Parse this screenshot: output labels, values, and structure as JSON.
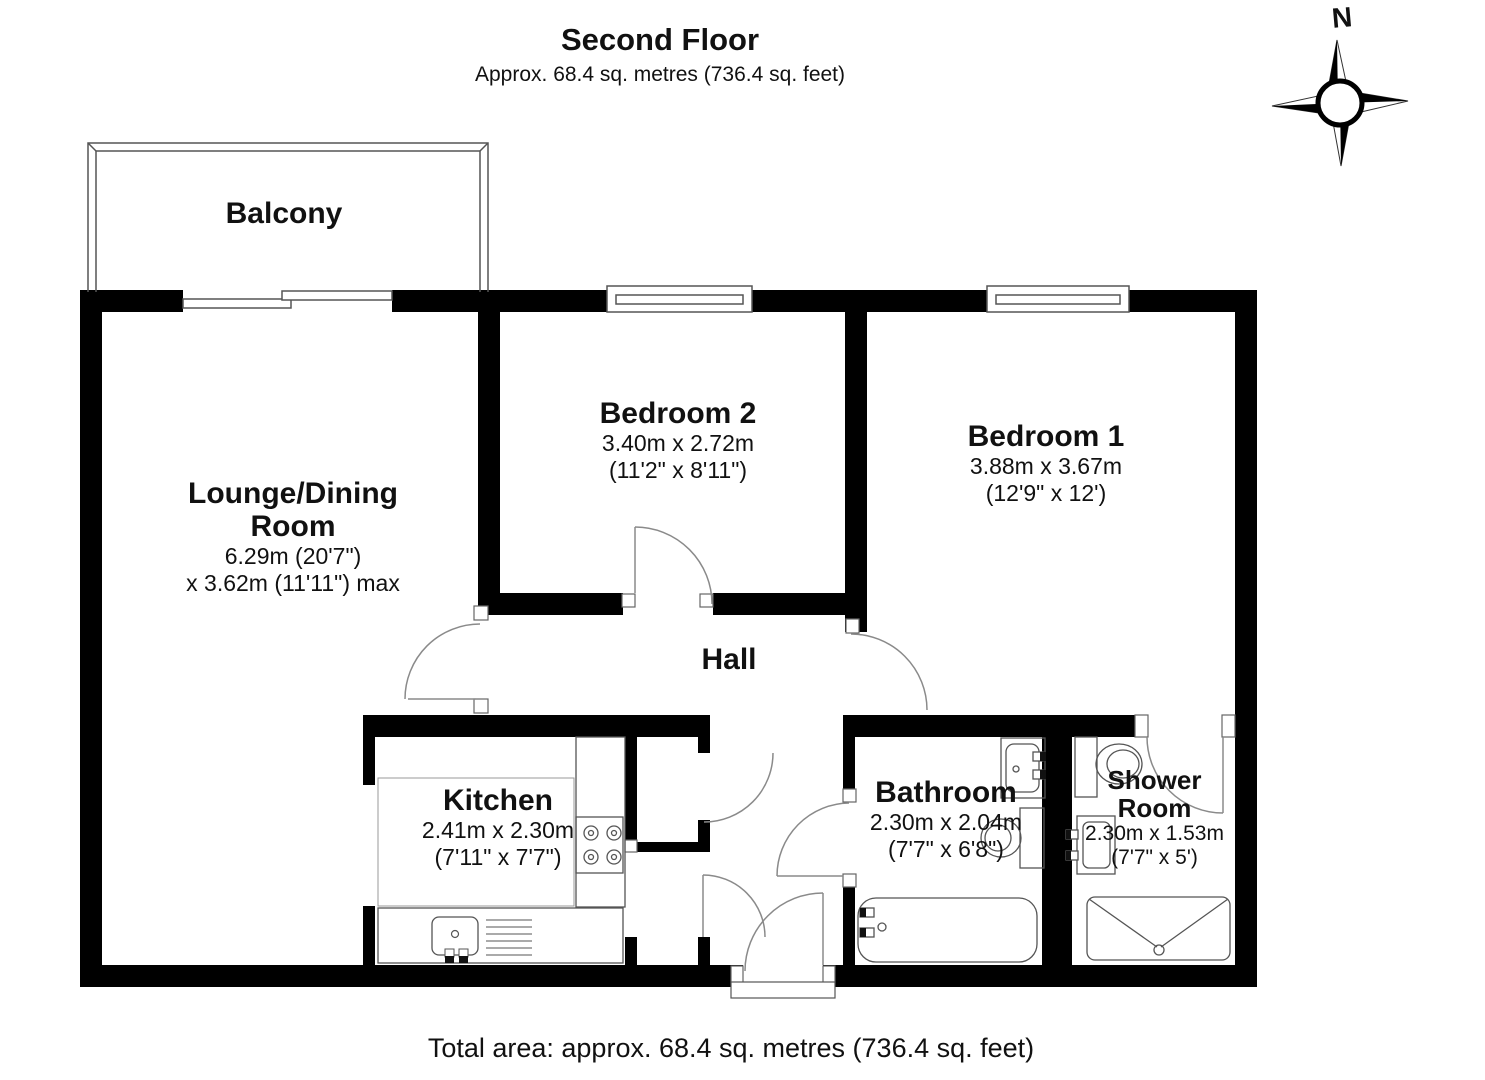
{
  "title": {
    "heading": "Second Floor",
    "subheading": "Approx. 68.4 sq. metres (736.4 sq. feet)"
  },
  "footer": {
    "total_area": "Total area: approx. 68.4 sq. metres (736.4 sq. feet)"
  },
  "compass": {
    "north_label": "N"
  },
  "rooms": {
    "balcony": {
      "name": "Balcony"
    },
    "lounge": {
      "name_line1": "Lounge/Dining",
      "name_line2": "Room",
      "dims_line1": "6.29m (20'7\")",
      "dims_line2": "x 3.62m (11'11\") max"
    },
    "bedroom2": {
      "name": "Bedroom 2",
      "dims_metric": "3.40m x 2.72m",
      "dims_imperial": "(11'2\" x 8'11\")"
    },
    "bedroom1": {
      "name": "Bedroom 1",
      "dims_metric": "3.88m x 3.67m",
      "dims_imperial": "(12'9\" x 12')"
    },
    "hall": {
      "name": "Hall"
    },
    "kitchen": {
      "name": "Kitchen",
      "dims_metric": "2.41m x 2.30m",
      "dims_imperial": "(7'11\" x 7'7\")"
    },
    "bathroom": {
      "name": "Bathroom",
      "dims_metric": "2.30m x 2.04m",
      "dims_imperial": "(7'7\" x 6'8\")"
    },
    "shower_room": {
      "name_line1": "Shower",
      "name_line2": "Room",
      "dims_metric": "2.30m x 1.53m",
      "dims_imperial": "(7'7\" x 5')"
    }
  },
  "colors": {
    "wall": "#000000",
    "fixture_line": "#5a5a5a",
    "door_arc": "#8a8a8a"
  }
}
